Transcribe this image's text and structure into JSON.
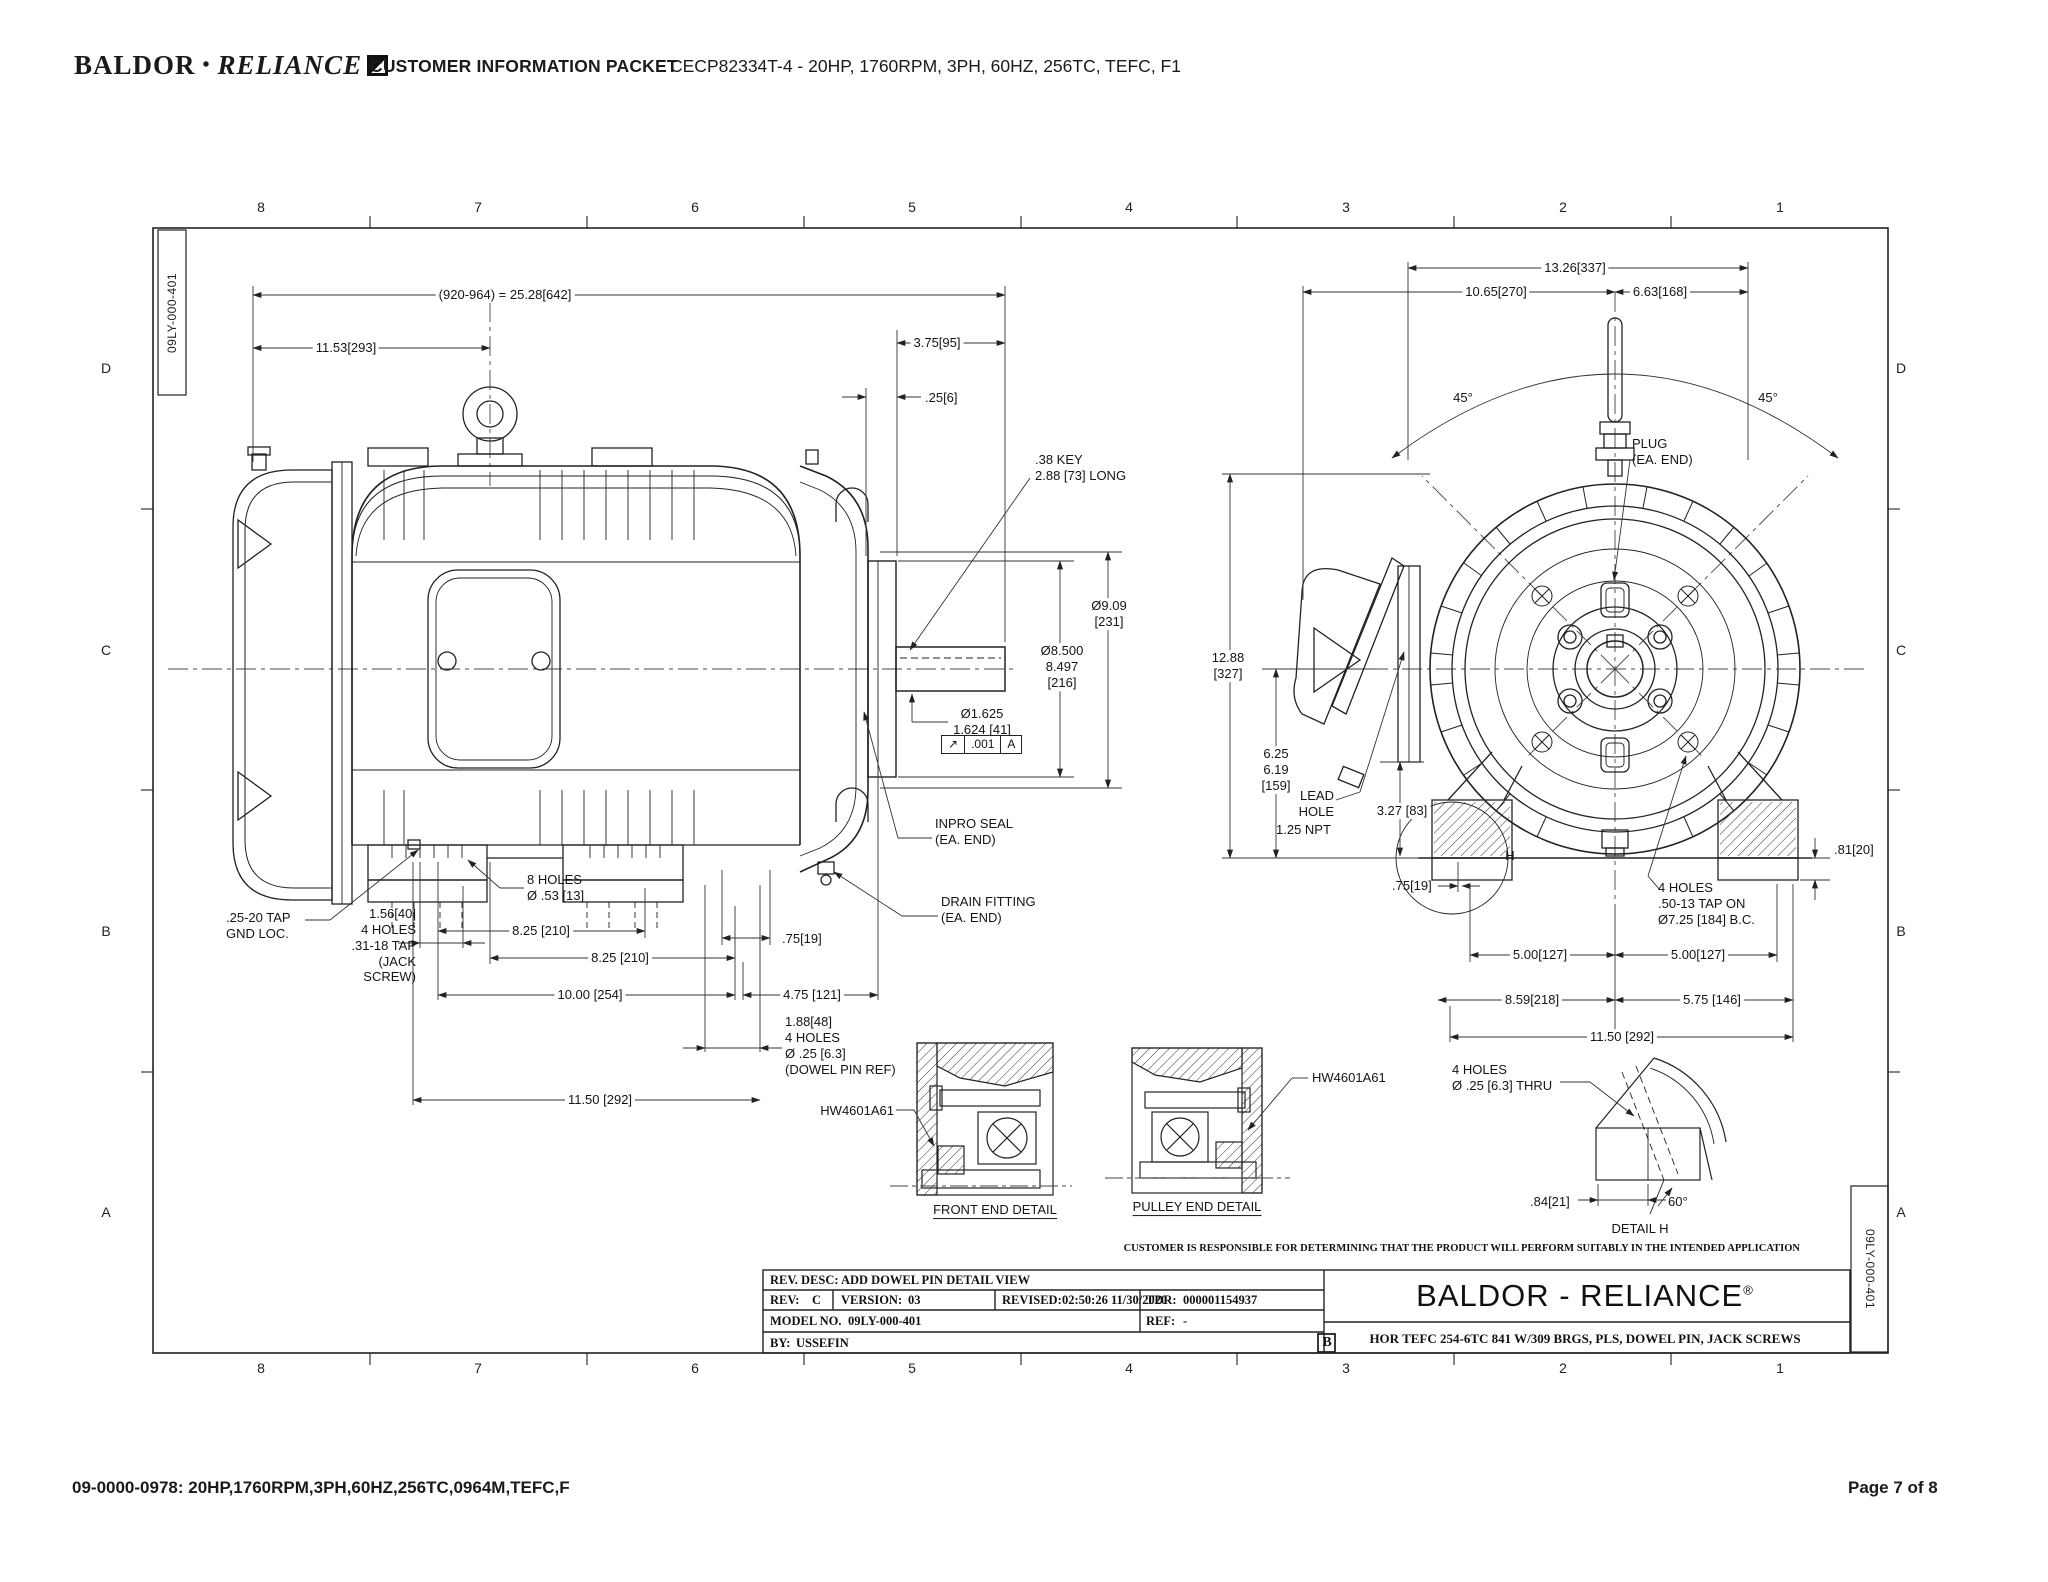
{
  "colors": {
    "ink": "#1a1a1a",
    "paper": "#ffffff"
  },
  "header": {
    "logo_baldor": "BALDOR",
    "logo_sep": "•",
    "logo_reliance": "RELIANCE",
    "logo_mark_icon": "abb-flag-square-icon",
    "packet_title": "CUSTOMER INFORMATION PACKET",
    "drawing_title": "CECP82334T-4 - 20HP, 1760RPM, 3PH, 60HZ, 256TC, TEFC, F1"
  },
  "footer": {
    "left": "09-0000-0978: 20HP,1760RPM,3PH,60HZ,256TC,0964M,TEFC,F",
    "right": "Page 7 of 8"
  },
  "sheet": {
    "doc_number": "09LY-000-401",
    "zones_h": [
      "8",
      "7",
      "6",
      "5",
      "4",
      "3",
      "2",
      "1"
    ],
    "zones_v": [
      "D",
      "C",
      "B",
      "A"
    ]
  },
  "left_view": {
    "overall": "(920-964) = 25.28[642]",
    "len_1153": "11.53[293]",
    "len_375": "3.75[95]",
    "len_025": ".25[6]",
    "key_note": ".38 KEY\n2.88 [73] LONG",
    "dia_909": "Ø9.09\n[231]",
    "dia_850": "Ø8.500\n8.497\n[216]",
    "dia_1625": "Ø1.625\n1.624 [41]",
    "gdt": {
      "symbol": "↗",
      "tolerance": ".001",
      "datum": "A"
    },
    "inpro_seal": "INPRO SEAL\n(EA. END)",
    "drain": "DRAIN FITTING\n(EA. END)",
    "holes_8": "8 HOLES\nØ .53 [13]",
    "gnd_tap": ".25-20 TAP\nGND LOC.",
    "jack_screw": "1.56[40]\n4 HOLES\n.31-18 TAP\n(JACK SCREW)",
    "len_825a": "8.25 [210]",
    "len_825b": "8.25 [210]",
    "len_075": ".75[19]",
    "len_1000": "10.00 [254]",
    "len_475": "4.75 [121]",
    "dowel_note": "1.88[48]\n4 HOLES\nØ .25 [6.3]\n(DOWEL PIN REF)",
    "len_1150": "11.50 [292]"
  },
  "right_view": {
    "w_1326": "13.26[337]",
    "w_1065": "10.65[270]",
    "w_663": "6.63[168]",
    "ang_left": "45°",
    "ang_right": "45°",
    "plug": "PLUG\n(EA. END)",
    "height_1288": "12.88\n[327]",
    "h_625": "6.25\n6.19\n[159]",
    "lead_hole": "LEAD\nHOLE",
    "npt": "1.25 NPT",
    "h_327": "3.27 [83]",
    "w_075": ".75[19]",
    "detail_letter": "H",
    "tap_note": "4 HOLES\n.50-13 TAP ON\nØ7.25 [184] B.C.",
    "w_500a": "5.00[127]",
    "w_500b": "5.00[127]",
    "w_859": "8.59[218]",
    "w_575": "5.75 [146]",
    "w_1150": "11.50 [292]",
    "pad_081": ".81[20]"
  },
  "details": {
    "hw_left": "HW4601A61",
    "hw_right": "HW4601A61",
    "front_title": "FRONT END DETAIL",
    "pulley_title": "PULLEY END DETAIL",
    "thru_note": "4 HOLES\nØ .25 [6.3] THRU",
    "w_084": ".84[21]",
    "ang_60": "60°",
    "title_h": "DETAIL H"
  },
  "disclaimer": "CUSTOMER IS RESPONSIBLE FOR DETERMINING THAT THE PRODUCT WILL PERFORM SUITABLY IN THE INTENDED APPLICATION",
  "title_block": {
    "rev_desc": "REV. DESC: ADD DOWEL PIN DETAIL VIEW",
    "rev_label": "REV:",
    "rev": "C",
    "version_label": "VERSION:",
    "version": "03",
    "revised_label": "REVISED:",
    "revised": "02:50:26 11/30/2020",
    "tdr_label": "TDR:",
    "tdr": "000001154937",
    "model_label": "MODEL NO.",
    "model": "09LY-000-401",
    "ref_label": "REF:",
    "ref": "-",
    "by_label": "BY:",
    "by": "USSEFIN",
    "size": "B",
    "brand": "BALDOR - RELIANCE",
    "reg": "®",
    "description": "HOR TEFC 254-6TC 841 W/309 BRGS, PLS, DOWEL PIN, JACK SCREWS"
  }
}
